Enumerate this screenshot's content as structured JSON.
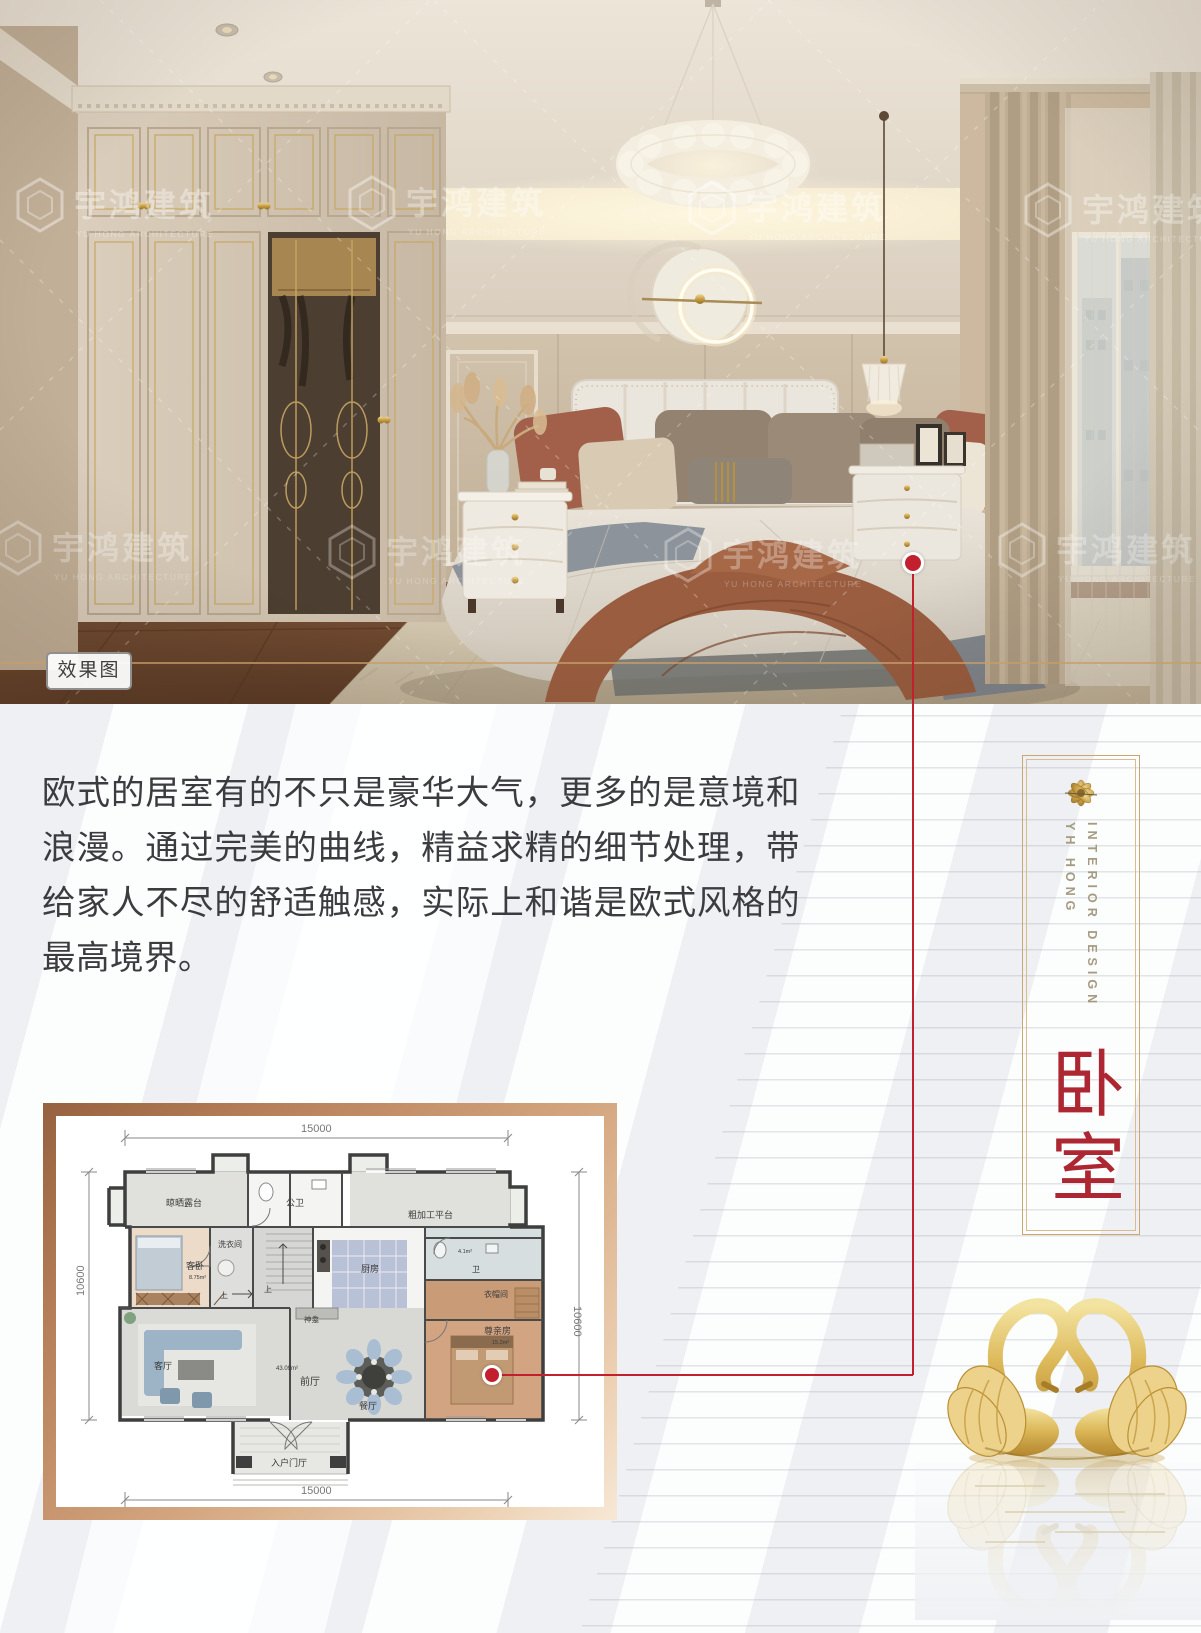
{
  "accent": {
    "red": "#c2202e",
    "gold": "#c9a76f",
    "bronze": "#b57e58"
  },
  "photo": {
    "label": "效果图",
    "watermark": {
      "cn": "宇鸿建筑",
      "en": "YU HONG ARCHITECTURE"
    }
  },
  "paragraph": {
    "text": "欧式的居室有的不只是豪华大气，更多的是意境和浪漫。通过完美的曲线，精益求精的细节处理，带给家人不尽的舒适触感，实际上和谐是欧式风格的最高境界。"
  },
  "side_panel": {
    "line1": "INTERIOR DESIGN",
    "line2": "YH HONG",
    "title": "卧室"
  },
  "floor_plan": {
    "dims": {
      "top": "15000",
      "bottom": "15000",
      "left": "10600",
      "right": "10600"
    },
    "rooms": {
      "terrace": "晾晒露台",
      "public_wc": "公卫",
      "platform": "粗加工平台",
      "laundry": "洗衣间",
      "guest_bedroom": "客卧",
      "guest_bedroom_area": "8.75m²",
      "kitchen": "厨房",
      "bath": "卫",
      "bath_area": "4.1m²",
      "cloakroom": "衣帽间",
      "shrine": "神龛",
      "living": "客厅",
      "front_hall": "前厅",
      "front_hall_area": "43.09m²",
      "dining": "餐厅",
      "elder_room": "尊亲房",
      "elder_room_area": "15.2m²",
      "entrance": "入户门厅",
      "stairs_up": "上"
    }
  }
}
